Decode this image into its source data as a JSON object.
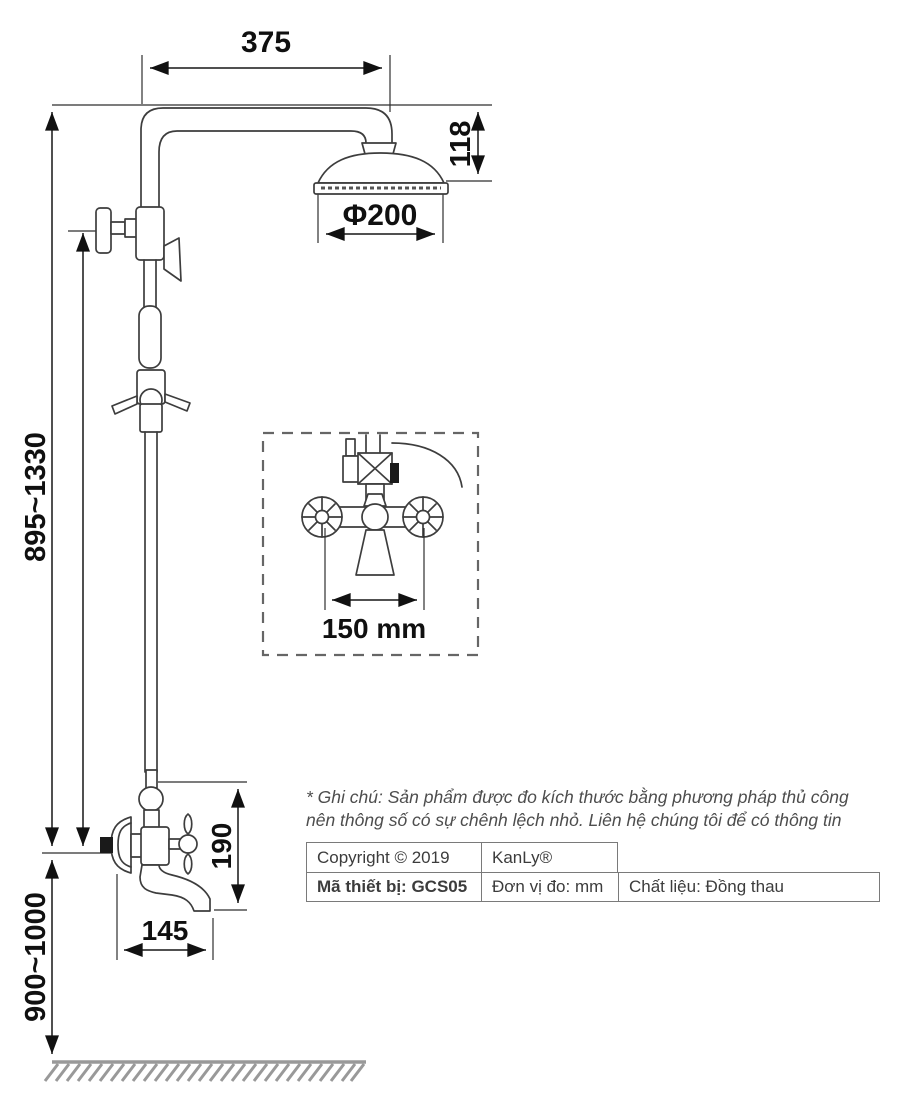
{
  "dimensions": {
    "arm_width": "375",
    "head_height": "118",
    "head_diameter": "Φ200",
    "column_height_range": "895~1330",
    "valve_center_distance": "150 mm",
    "spout_drop": "190",
    "spout_reach": "145",
    "mount_height_range": "900~1000"
  },
  "note": {
    "line1": "* Ghi chú: Sản phẩm được đo kích thước bằng phương pháp thủ công",
    "line2": "nên thông số có sự chênh lệch nhỏ. Liên hệ chúng tôi để có thông tin"
  },
  "info_table": {
    "copyright": "Copyright © 2019",
    "brand": "KanLy®",
    "device_code": "Mã thiết bị: GCS05",
    "unit": "Đơn vị đo: mm",
    "material": "Chất liệu: Đồng thau"
  }
}
